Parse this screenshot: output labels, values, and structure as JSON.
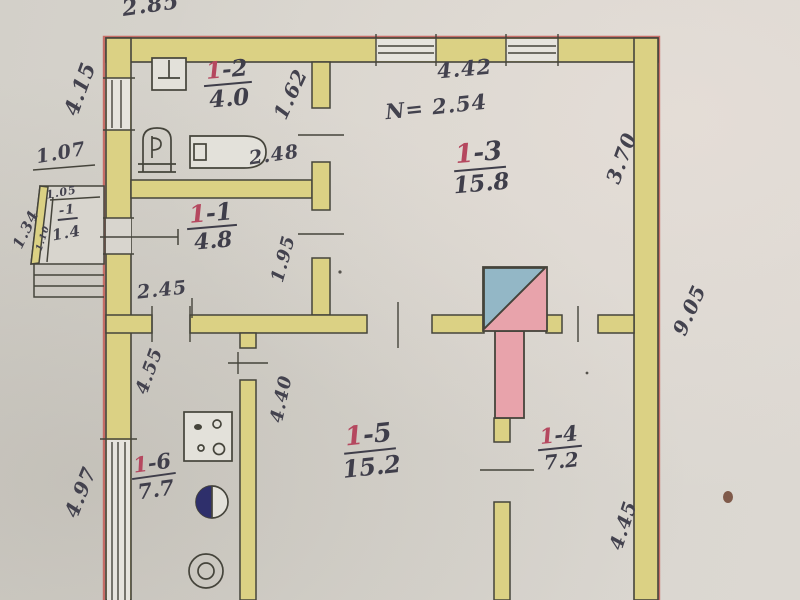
{
  "document": {
    "type": "hand-drawn apartment floor plan (scanned inventory sheet)",
    "ceiling_height_note": "N= 2.54"
  },
  "rooms": {
    "r1": {
      "num": "1",
      "suffix": "-1",
      "area": "4.8"
    },
    "r2": {
      "num": "1",
      "suffix": "-2",
      "area": "4.0"
    },
    "r3": {
      "num": "1",
      "suffix": "-3",
      "area": "15.8"
    },
    "r4": {
      "num": "1",
      "suffix": "-4",
      "area": "7.2"
    },
    "r5": {
      "num": "1",
      "suffix": "-5",
      "area": "15.2"
    },
    "r6": {
      "num": "1",
      "suffix": "-6",
      "area": "7.7"
    },
    "porch": {
      "label": "-1",
      "area": "1.4"
    }
  },
  "dimensions": {
    "top_extension": "2.85",
    "left_wall_upper": "4.15",
    "porch_opening": "1.07",
    "porch_inner_top": "1.05",
    "porch_left_side": "1.34",
    "porch_inner_left": "1.10",
    "bathroom_depth": "1.62",
    "bathtub_length": "2.48",
    "room3_width": "4.42",
    "room3_depth": "3.70",
    "right_wall_length": "9.05",
    "room1_wall_segment": "1.95",
    "room1_width": "2.45",
    "kitchen_left_depth": "4.55",
    "room5_left_depth": "4.40",
    "left_wall_lower": "4.97",
    "room4_right_depth": "4.45"
  },
  "fixtures": {
    "bathroom": [
      "washbasin",
      "toilet",
      "bathtub"
    ],
    "kitchen": [
      "gas-stove",
      "kitchen-sink",
      "water-heater"
    ],
    "center": [
      "stove-chimney-with-blue-corner"
    ],
    "outside": [
      "entry-porch",
      "porch-steps"
    ]
  },
  "colors": {
    "paper": "#d8d5ce",
    "wall_fill": "#dbd184",
    "wall_line": "#45443b",
    "exterior_red_line": "#c4635c",
    "room_number_red": "#b5485f",
    "ink": "#43424e",
    "chimney_pink": "#e8a3ab",
    "chimney_corner_blue": "#93b7c6",
    "sink_navy": "#2e2f6b"
  }
}
